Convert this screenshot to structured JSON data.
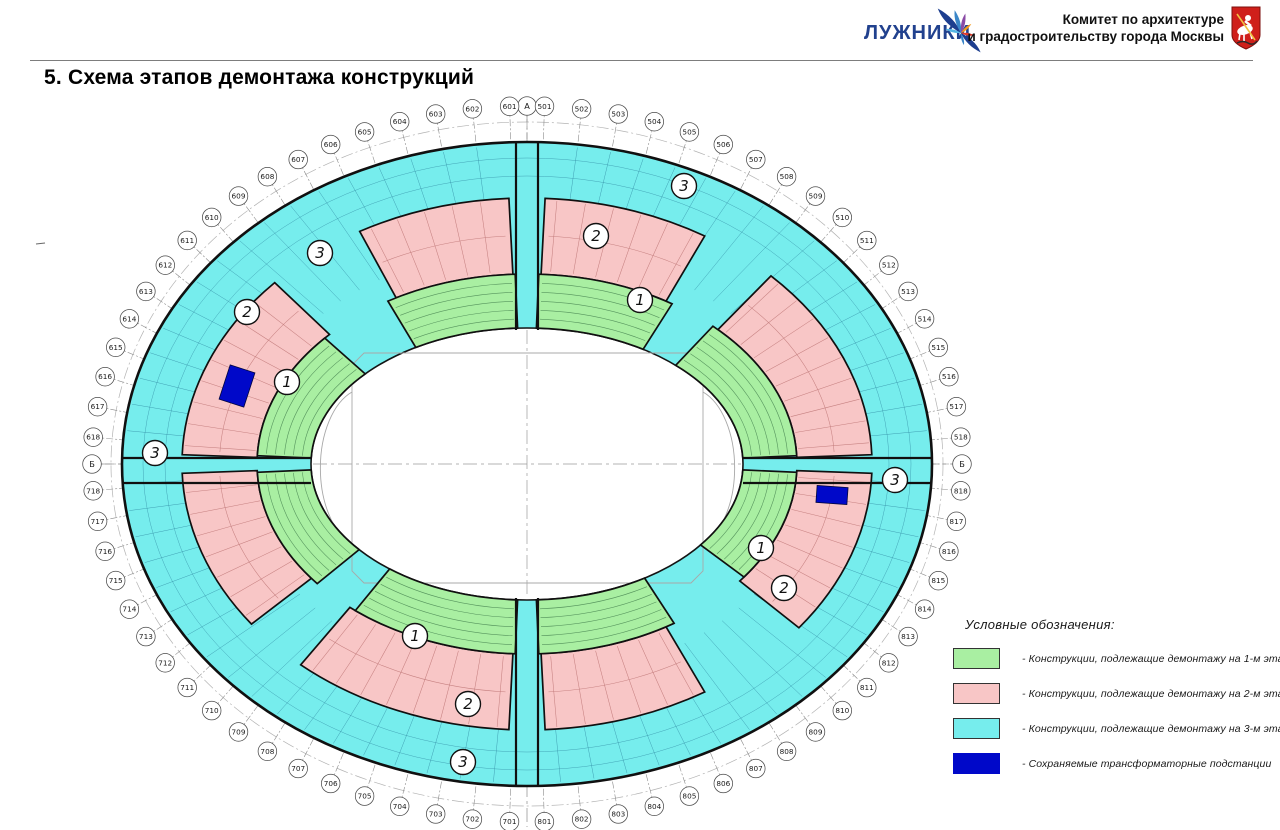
{
  "header": {
    "logo": "ЛУЖНИКИ",
    "committee": [
      "Комитет по архитектуре",
      "и градостроительству города Москвы"
    ]
  },
  "title": "5. Схема этапов демонтажа конструкций",
  "legend": {
    "title": "Условные обозначения:",
    "items": [
      {
        "color": "#a9efa2",
        "label": "- Конструкции, подлежащие демонтажу на 1-м этапе"
      },
      {
        "color": "#f8c6c6",
        "label": "- Конструкции, подлежащие демонтажу на 2-м этапе"
      },
      {
        "color": "#76eded",
        "label": "- Конструкции, подлежащие демонтажу на 3-м этапе"
      },
      {
        "color": "#0008c9",
        "label": "- Сохраняемые трансформаторные подстанции"
      }
    ]
  },
  "plan": {
    "axis_letter_top": "А",
    "axis_letter_side": "Б",
    "stage_zone_labels": {
      "stage1": "1",
      "stage2": "2",
      "stage3": "3"
    },
    "axis_series": {
      "s500": [
        "501",
        "502",
        "503",
        "504",
        "505",
        "506",
        "507",
        "508",
        "509",
        "510",
        "511",
        "512",
        "513",
        "514",
        "515",
        "516",
        "517",
        "518"
      ],
      "s600": [
        "601",
        "602",
        "603",
        "604",
        "605",
        "606",
        "607",
        "608",
        "609",
        "610",
        "611",
        "612",
        "613",
        "614",
        "615",
        "616",
        "617",
        "618"
      ],
      "s700": [
        "701",
        "702",
        "703",
        "704",
        "705",
        "706",
        "707",
        "708",
        "709",
        "710",
        "711",
        "712",
        "713",
        "714",
        "715",
        "716",
        "717",
        "718"
      ],
      "s800": [
        "801",
        "802",
        "803",
        "804",
        "805",
        "806",
        "807",
        "808",
        "809",
        "810",
        "811",
        "812",
        "813",
        "814",
        "815",
        "816",
        "817",
        "818"
      ]
    },
    "colors": {
      "stage1": "#a9efa2",
      "stage2": "#f8c6c6",
      "stage3": "#76eded",
      "substation": "#0008c9"
    }
  }
}
